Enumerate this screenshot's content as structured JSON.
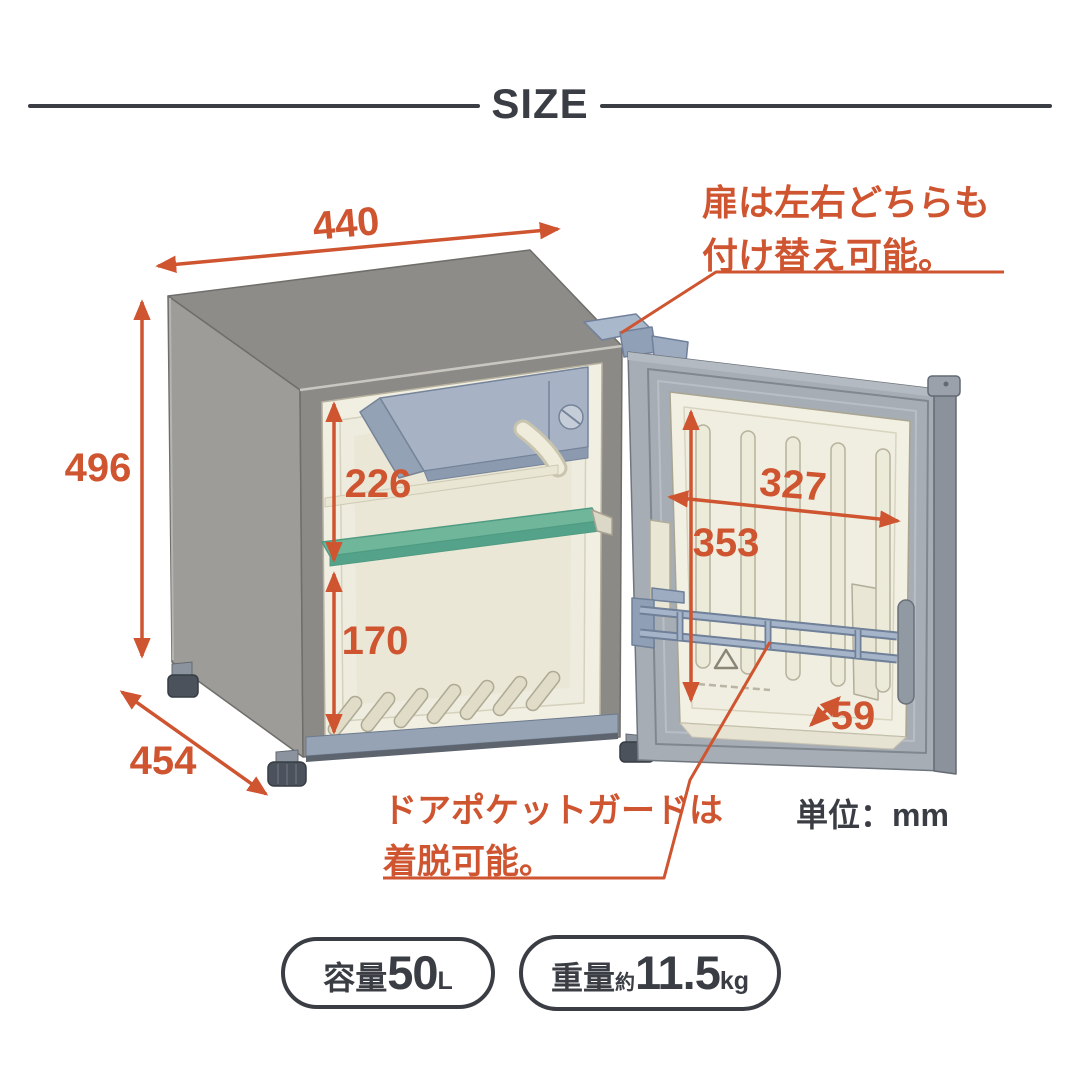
{
  "header": {
    "title": "SIZE"
  },
  "colors": {
    "accent": "#cf5430",
    "ink": "#3a3e44",
    "cabinet_gray": "#8d8c88",
    "interior_cream": "#f1efe2",
    "shelf_green": "#6fb69b",
    "freezer_blue": "#a7b3c5",
    "door_gray": "#a6adb5"
  },
  "dimensions": {
    "width": {
      "value": "440"
    },
    "height": {
      "value": "496"
    },
    "depth": {
      "value": "454"
    },
    "inner_upper_height": {
      "value": "226"
    },
    "inner_lower_height": {
      "value": "170"
    },
    "door_inner_width": {
      "value": "327"
    },
    "door_inner_height": {
      "value": "353"
    },
    "door_pocket_depth": {
      "value": "59"
    }
  },
  "unit_note": "単位：mm",
  "annotations": {
    "door_reversible": {
      "line1": "扉は左右どちらも",
      "line2": "付け替え可能。"
    },
    "door_pocket": {
      "line1": "ドアポケットガードは",
      "line2": "着脱可能。"
    }
  },
  "badges": {
    "capacity": {
      "label": "容量",
      "value": "50",
      "unit": "L"
    },
    "weight": {
      "label": "重量",
      "prefix": "約",
      "value": "11.5",
      "unit": "kg"
    }
  }
}
